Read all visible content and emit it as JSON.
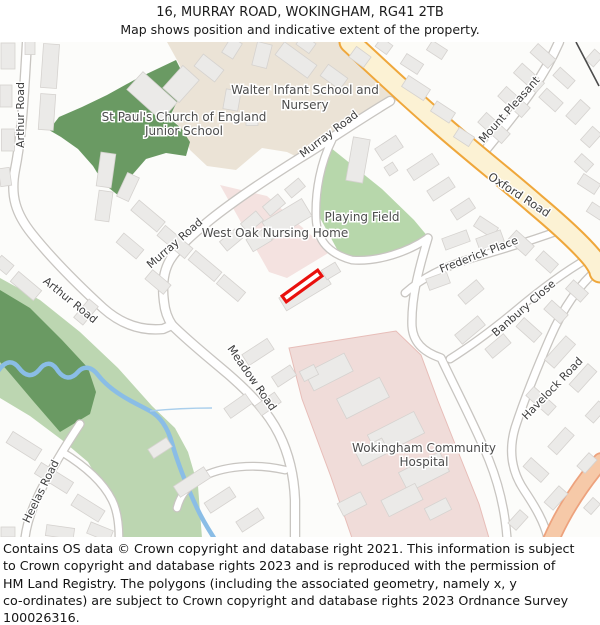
{
  "header": {
    "title": "16, MURRAY ROAD, WOKINGHAM, RG41 2TB",
    "subtitle": "Map shows position and indicative extent of the property."
  },
  "map": {
    "labels": {
      "arthur_road_top": "Arthur Road",
      "arthur_road_lower": "Arthur Road",
      "murray_road_upper": "Murray Road",
      "murray_road_lower": "Murray Road",
      "oxford_road": "Oxford Road",
      "mount_pleasant": "Mount Pleasant",
      "frederick_place": "Frederick Place",
      "banbury_close": "Banbury Close",
      "havelock_road": "Havelock Road",
      "meadow_road": "Meadow Road",
      "heelas_road": "Heelas Road",
      "walter_school_line1": "Walter Infant School and",
      "walter_school_line2": "Nursery",
      "st_pauls_line1": "St Paul's Church of England",
      "st_pauls_line2": "Junior School",
      "playing_field": "Playing Field",
      "west_oak_nursing_home": "West Oak Nursing Home",
      "hospital_line1": "Wokingham Community",
      "hospital_line2": "Hospital"
    },
    "colors": {
      "plot_red": "#e9100d",
      "main_road_fill": "#fcf2d4",
      "main_road_casing": "#efa73b",
      "minor_road_fill": "#ffffff",
      "minor_road_casing": "#c8c5c1",
      "edge_road_fill": "#f6c9a8",
      "edge_road_casing": "#eda27d",
      "woodland_green": "#6a9a63",
      "grass_green": "#bcd6b1",
      "field_green": "#b7d7ab",
      "school_beige": "#ebe3d6",
      "hospital_pink": "#f0dcd9",
      "nursing_pink": "#f4e2e0",
      "water_blue": "#8abde6",
      "building_grey": "#ebeae8",
      "boundary_line": "#4c4c4c"
    }
  },
  "footer": {
    "lines": [
      "Contains OS data © Crown copyright and database right 2021. This information is subject",
      "to Crown copyright and database rights 2023 and is reproduced with the permission of",
      "HM Land Registry. The polygons (including the associated geometry, namely x, y",
      "co-ordinates) are subject to Crown copyright and database rights 2023 Ordnance Survey",
      "100026316."
    ]
  }
}
